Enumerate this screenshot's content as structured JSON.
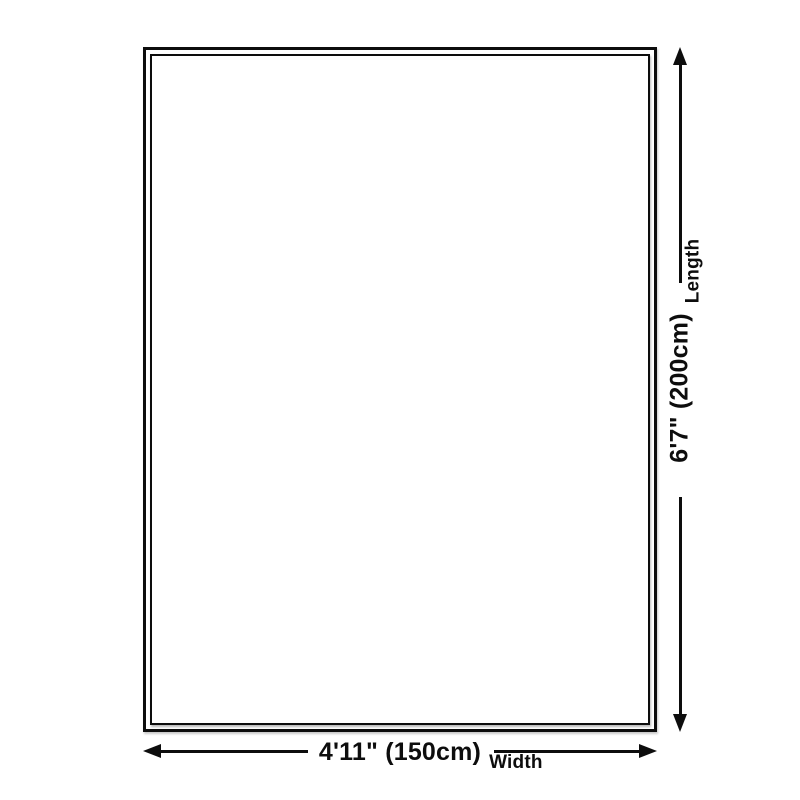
{
  "page": {
    "background": "#ffffff",
    "line_color": "#0d0d0d"
  },
  "diagram": {
    "name": "Rug size dimension diagram",
    "shape": "rectangle-double-border",
    "dimensions": {
      "length": {
        "value": "6'7\" (200cm)",
        "label": "Length"
      },
      "width": {
        "value": "4'11\" (150cm)",
        "label": "Width"
      }
    }
  }
}
